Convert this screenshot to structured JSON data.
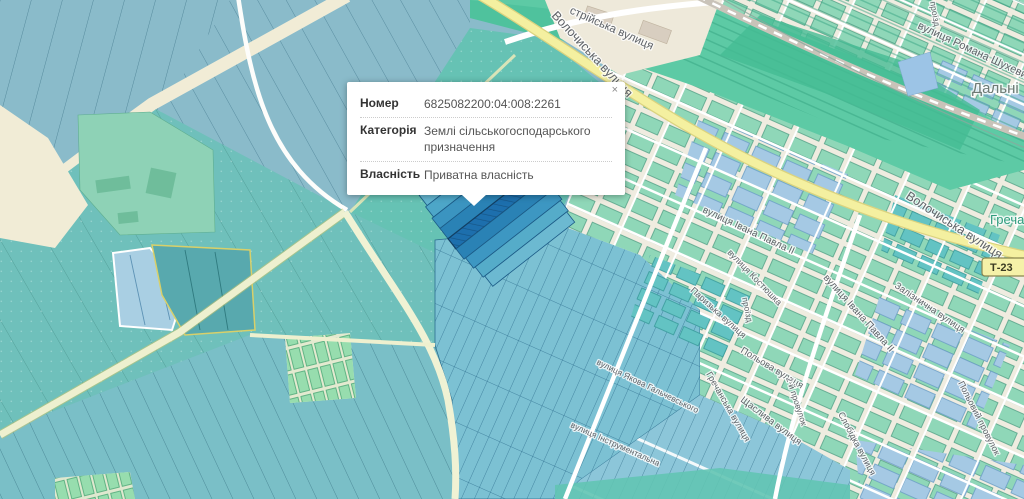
{
  "popup": {
    "close": "×",
    "rows": [
      {
        "label": "Номер",
        "value": "6825082200:04:008:2261"
      },
      {
        "label": "Категорія",
        "value": "Землі сільськогосподарського призначення"
      },
      {
        "label": "Власність",
        "value": "Приватна власність"
      }
    ]
  },
  "map": {
    "road_shield": {
      "text": "Т-23"
    },
    "place_labels": [
      {
        "text": "Дальні"
      },
      {
        "text": "Гречани"
      }
    ],
    "street_labels": [
      {
        "text": "Волочиська вулиця"
      },
      {
        "text": "Волочиська вулиця"
      },
      {
        "text": "стрійська вулиця"
      },
      {
        "text": "вулиця Романа Шухевича"
      },
      {
        "text": "проїзд"
      },
      {
        "text": "Залізнична вулиця"
      },
      {
        "text": "вулиця Івана Павла ІІ"
      },
      {
        "text": "вулиця Івана Павла ІІ"
      },
      {
        "text": "вулиця Костюшка"
      },
      {
        "text": "Паризька вулиця"
      },
      {
        "text": "Гречанська вулиця"
      },
      {
        "text": "Польова вулиця"
      },
      {
        "text": "Щаслива вулиця"
      },
      {
        "text": "2-й провулок"
      },
      {
        "text": "проїзд"
      },
      {
        "text": "Польовий провулок"
      },
      {
        "text": "Слобідка вулиця"
      },
      {
        "text": "вулиця Якова Гальчевського"
      },
      {
        "text": "вулиця Інструментальна"
      }
    ],
    "colors": {
      "parcel_blue": "#8abbca",
      "parcel_teal": "#6fc0bb",
      "selected_parcel": "#1d6fad",
      "road_yellow": "#f4f0a0",
      "rail_green": "#5dcaa5",
      "urban_mint": "#8fd7b8",
      "urban_base": "#efece0",
      "popup_bg": "#ffffff"
    }
  }
}
